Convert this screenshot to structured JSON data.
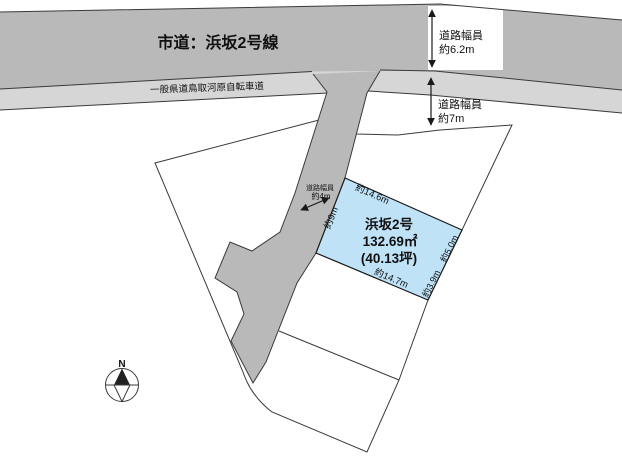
{
  "map": {
    "main_road_label": "市道：浜坂2号線",
    "bike_path_label": "一般県道鳥取河原自転車道",
    "annotations": {
      "top_width_label": "道路幅員",
      "top_width_value": "約6.2m",
      "mid_width_label": "道路幅員",
      "mid_width_value": "約7m",
      "side_width_label": "道路幅員",
      "side_width_value": "約4m"
    },
    "parcel": {
      "name": "浜坂2号",
      "area_m2": "132.69㎡",
      "area_tsubo": "(40.13坪)",
      "dim_top": "約14.6m",
      "dim_bottom": "約14.7m",
      "dim_left": "約9m",
      "dim_right_upper": "約5.0m",
      "dim_right_lower": "約3.9m"
    },
    "compass": {
      "north": "N"
    },
    "colors": {
      "road_fill": "#b9b9b9",
      "bike_path_fill": "#d6d6d6",
      "branch_road_fill": "#b9b9b9",
      "parcel_fill": "#bfe2f7",
      "line": "#3a3a3a"
    }
  }
}
